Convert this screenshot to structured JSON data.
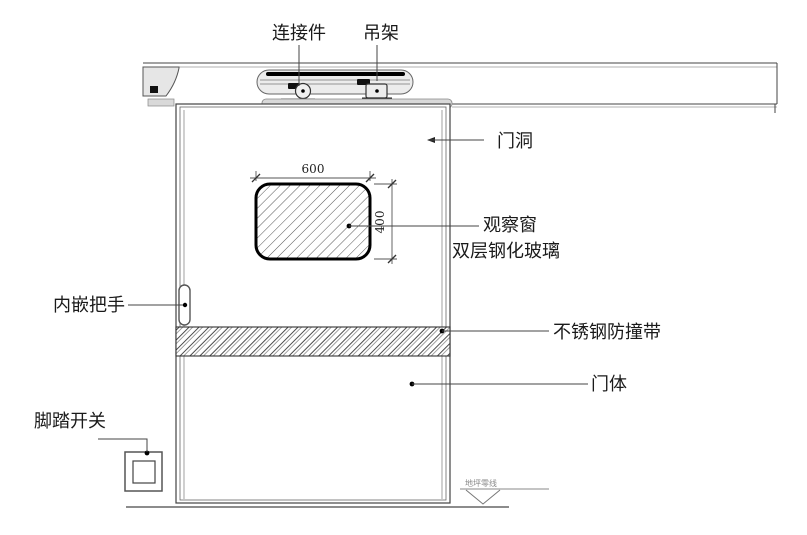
{
  "annotations": {
    "connector": "连接件",
    "hanger": "吊架",
    "door_opening": "门洞",
    "observation_window": "观察窗",
    "glass": "双层钢化玻璃",
    "handle": "内嵌把手",
    "bumper": "不锈钢防撞带",
    "door_body": "门体",
    "foot_switch": "脚踏开关",
    "floor_level": "地坪零线"
  },
  "dimensions": {
    "window_width": "600",
    "window_height": "400"
  },
  "colors": {
    "line": "#444444",
    "metal_fill": "#e6e6e6",
    "dark_part": "#111111",
    "background": "#ffffff"
  }
}
